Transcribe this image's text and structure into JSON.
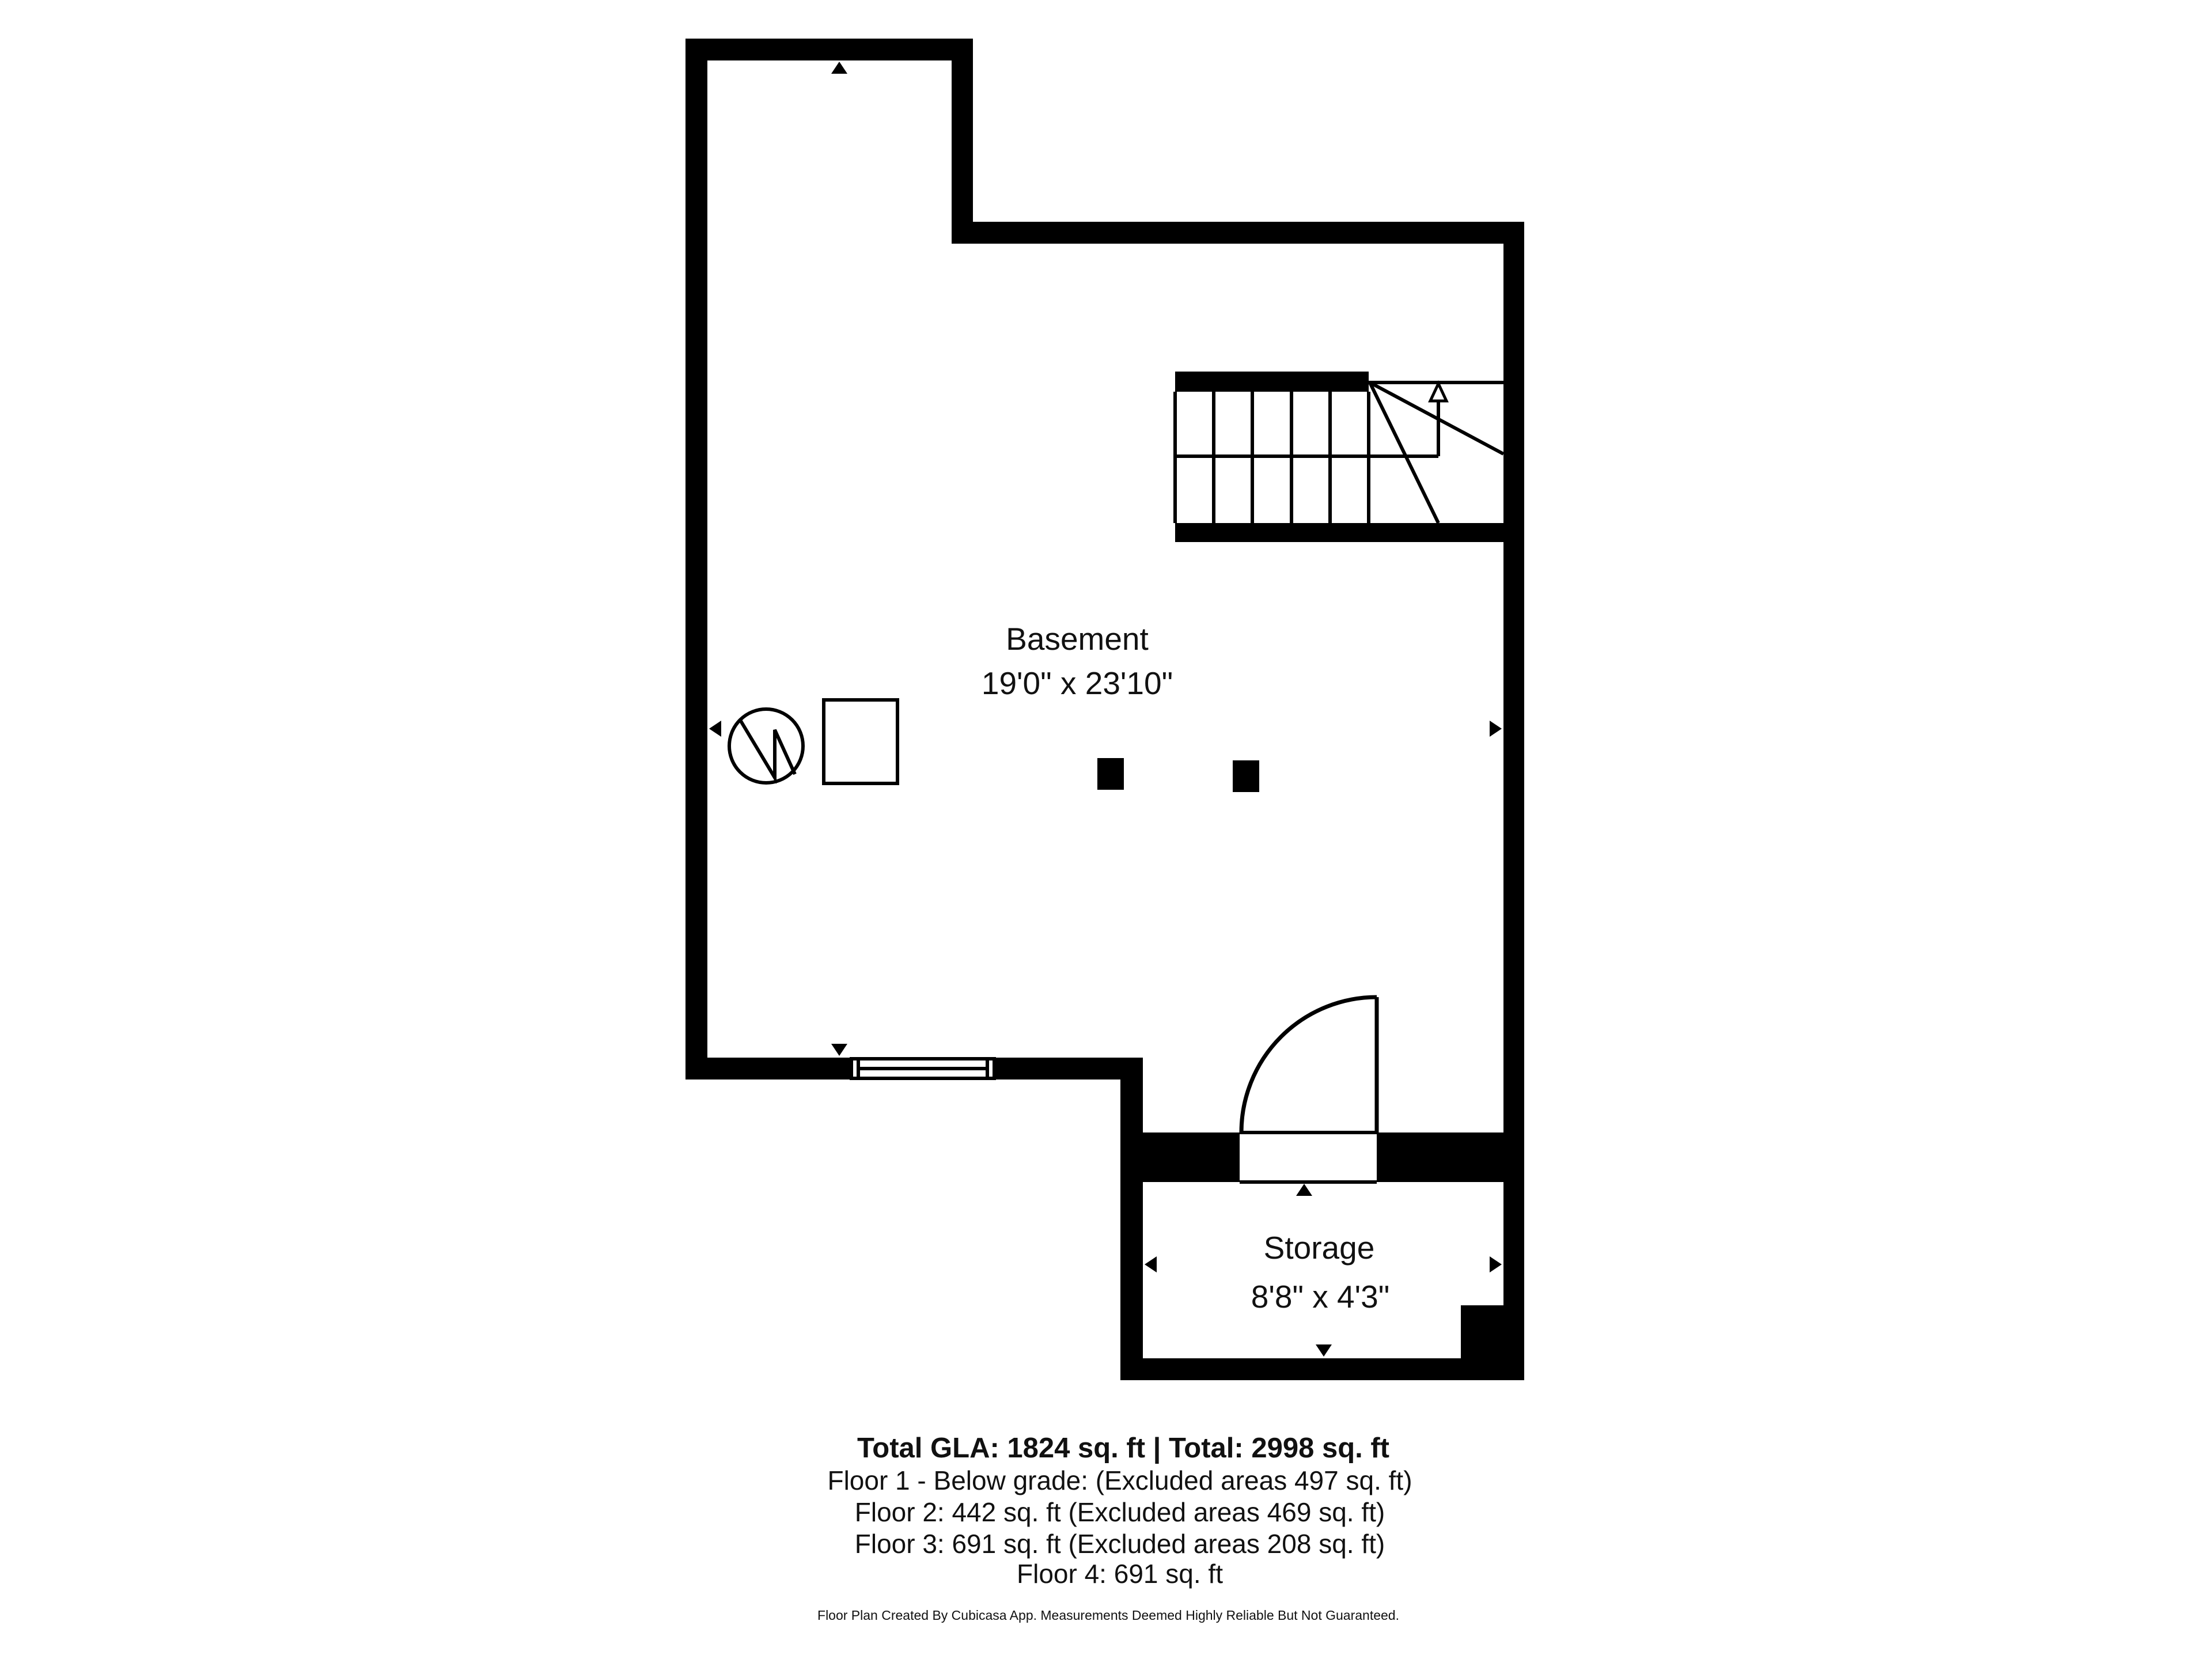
{
  "colors": {
    "wall": "#000000",
    "background": "#ffffff",
    "text": "#111111"
  },
  "plan": {
    "rooms": [
      {
        "name": "Basement",
        "dims": "19'0\" x 23'10\""
      },
      {
        "name": "Storage",
        "dims": "8'8\" x 4'3\""
      }
    ],
    "symbols": [
      "water-heater",
      "furnace",
      "support-post",
      "support-post",
      "stairs-up",
      "door-swing",
      "window",
      "dimension-arrows"
    ]
  },
  "summary": {
    "total": "Total GLA: 1824 sq. ft | Total: 2998 sq. ft",
    "floors": [
      "Floor 1 - Below grade: (Excluded areas 497 sq. ft)",
      "Floor 2: 442 sq. ft (Excluded areas 469 sq. ft)",
      "Floor 3: 691 sq. ft (Excluded areas 208 sq. ft)",
      "Floor 4: 691 sq. ft"
    ]
  },
  "footer": {
    "disclaimer": "Floor Plan Created By Cubicasa App. Measurements Deemed Highly Reliable But Not Guaranteed."
  }
}
